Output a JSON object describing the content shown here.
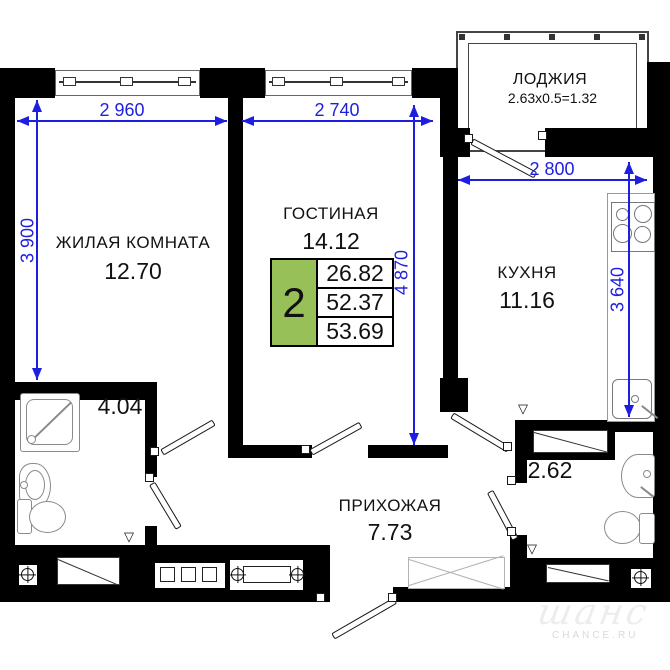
{
  "rooms": {
    "living_room": {
      "name": "ЖИЛАЯ КОМНАТА",
      "area": "12.70"
    },
    "lounge": {
      "name": "ГОСТИНАЯ",
      "area": "14.12"
    },
    "loggia": {
      "name": "ЛОДЖИЯ",
      "area_calc": "2.63x0.5=1.32"
    },
    "kitchen": {
      "name": "КУХНЯ",
      "area": "11.16"
    },
    "hallway": {
      "name": "ПРИХОЖАЯ",
      "area": "7.73"
    },
    "bathroom": {
      "area": "4.04"
    },
    "wc": {
      "area": "2.62"
    }
  },
  "dimensions_mm": {
    "living_room_width": "2 960",
    "lounge_width": "2 740",
    "kitchen_width": "2 800",
    "living_room_depth": "3 900",
    "lounge_depth": "4 870",
    "kitchen_depth": "3 640"
  },
  "apartment_card": {
    "rooms_count": "2",
    "living_area": "26.82",
    "area": "52.37",
    "total_area": "53.69"
  },
  "watermark": {
    "logo_text": "шанс",
    "site_text": "CHANCE.RU"
  },
  "colors": {
    "dimension_blue": "#1e1ee0",
    "card_green": "#97c158",
    "wall_black": "#000000"
  }
}
